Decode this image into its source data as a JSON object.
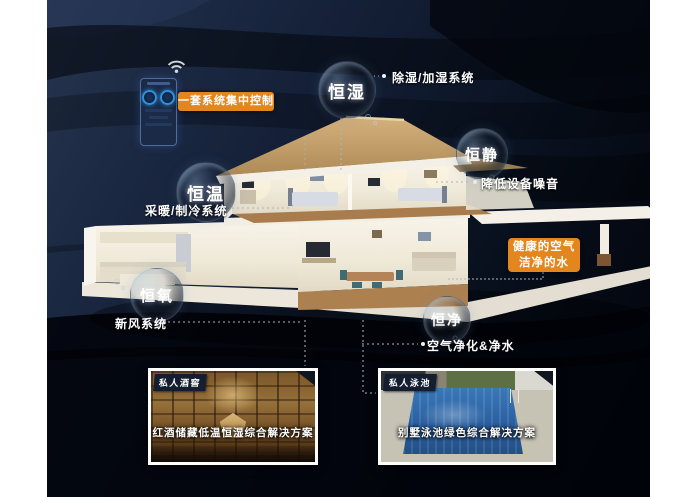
{
  "panel": {
    "label": "一套系统集中控制"
  },
  "features": [
    {
      "name": "恒湿",
      "annotation": "除湿/加湿系统"
    },
    {
      "name": "恒静",
      "annotation": "降低设备噪音"
    },
    {
      "name": "恒温",
      "annotation": "采暖/制冷系统"
    },
    {
      "name": "恒氧",
      "annotation": "新风系统"
    },
    {
      "name": "恒净",
      "annotation": "空气净化&净水"
    }
  ],
  "highlight": {
    "line1": "健康的空气",
    "line2": "洁净的水"
  },
  "insets": [
    {
      "badge": "私人酒窖",
      "caption": "红酒储藏低温恒湿综合解决方案"
    },
    {
      "badge": "私人泳池",
      "caption": "别墅泳池绿色综合解决方案"
    }
  ],
  "icons": {
    "wifi": "wifi"
  },
  "colors": {
    "accent_orange": "#e2861d",
    "background_navy": "#121d33",
    "margin_white": "#ffffff"
  }
}
